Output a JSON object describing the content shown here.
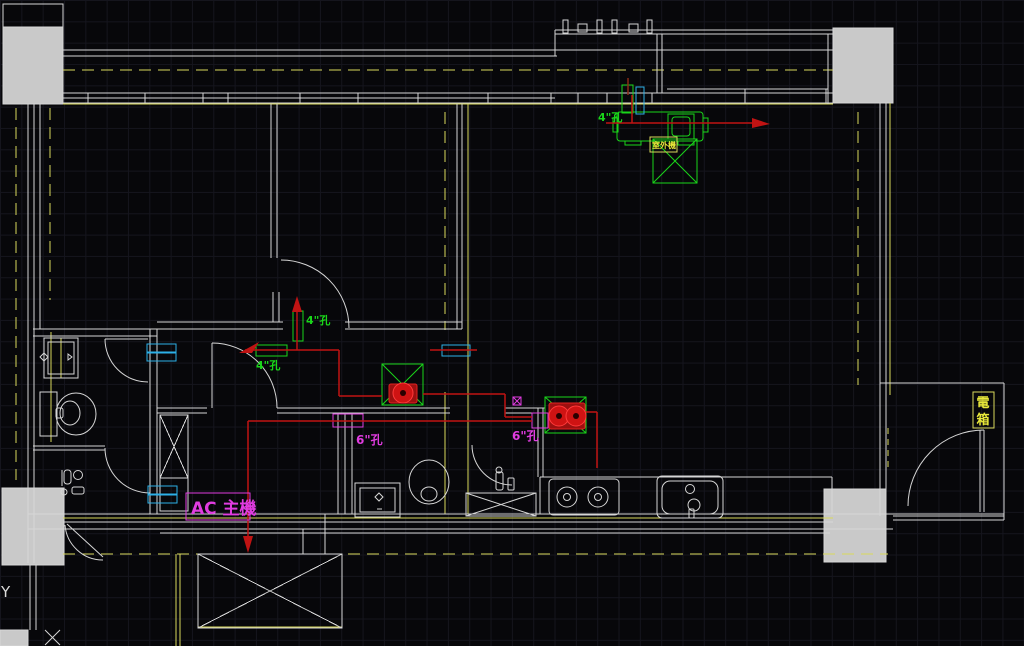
{
  "app": {
    "name": "cad-floor-plan-hvac"
  },
  "colors": {
    "bg": "#07070a",
    "grid": "#15151d",
    "wall": "#d6d6d6",
    "columnFill": "#c9c9c9",
    "yellow": "#d9d95c",
    "yellowBright": "#e8e83a",
    "green": "#1ad61a",
    "cyan": "#2cb0e8",
    "magenta": "#e03ce0",
    "red": "#c01313"
  },
  "annotations": {
    "hole_4_balcony": "4\"孔",
    "hole_4_bedroom_wall": "4\"孔",
    "hole_4_hall": "4\"孔",
    "hole_6_hall": "6\"孔",
    "hole_6_dining": "6\"孔",
    "ac_main_unit": "AC 主機",
    "electrical_box_top": "電",
    "electrical_box_bottom": "箱",
    "outdoor_unit_tag": "室外機",
    "axis_y_label": "Y"
  }
}
